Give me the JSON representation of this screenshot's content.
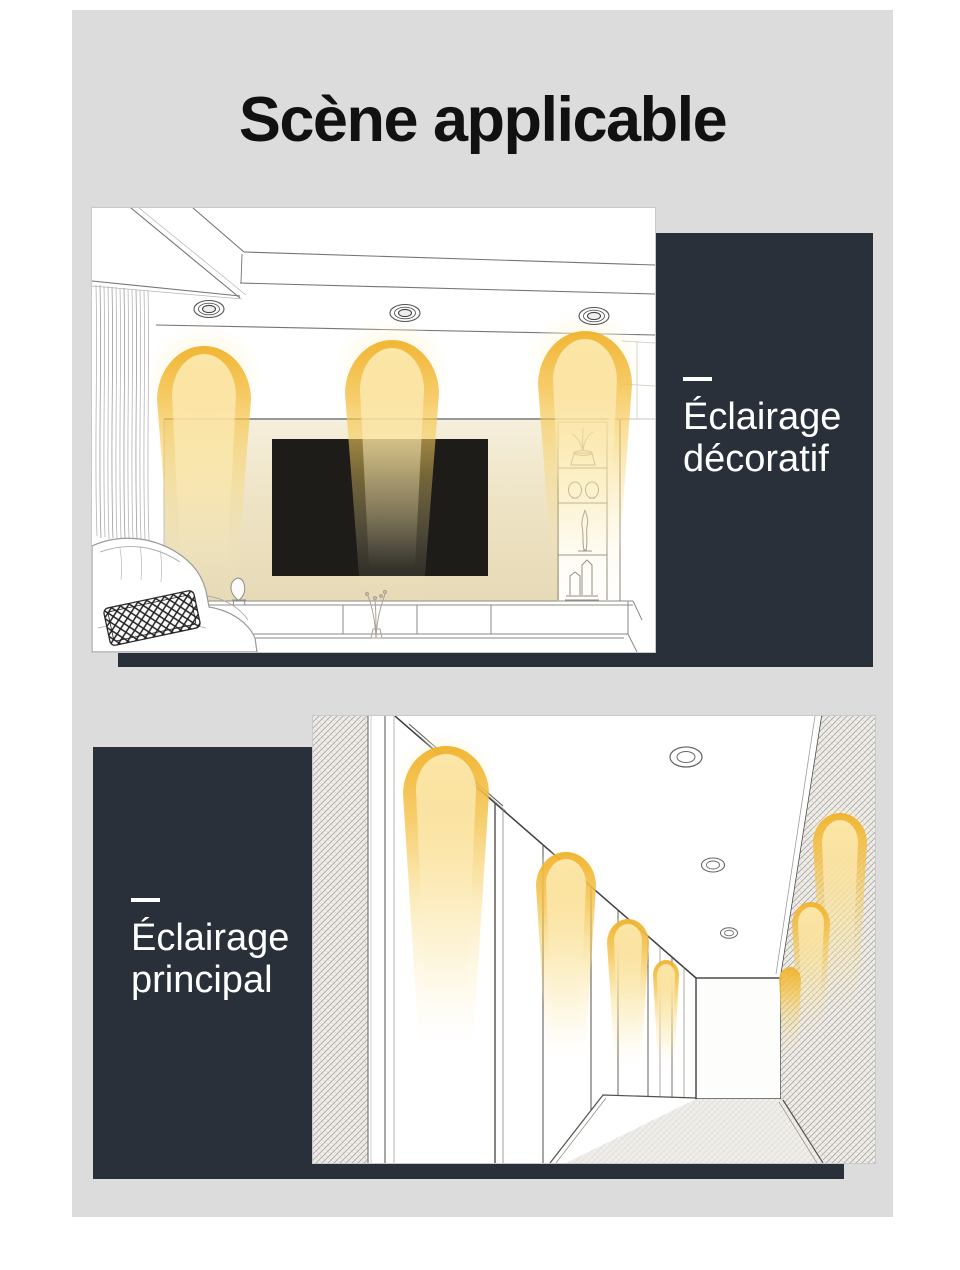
{
  "page": {
    "title": "Scène applicable"
  },
  "colors": {
    "canvas_bg": "#dcdcdc",
    "panel_dark": "#2a303a",
    "title_color": "#111111",
    "label_color": "#ffffff",
    "glow_rim": "#f0b22a",
    "glow_soft": "#fbe8a8"
  },
  "sections": [
    {
      "name": "decorative-lighting",
      "label": {
        "line1": "Éclairage",
        "line2": "décoratif"
      }
    },
    {
      "name": "main-lighting",
      "label": {
        "line1": "Éclairage",
        "line2": "principal"
      }
    }
  ]
}
